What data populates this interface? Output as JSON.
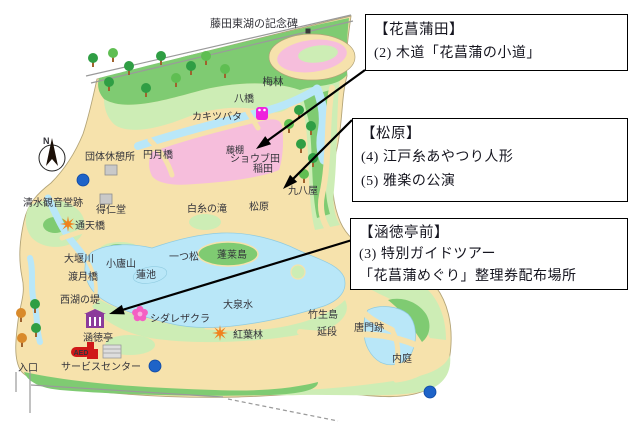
{
  "annotations": {
    "boxes": [
      {
        "id": "hanashobuda",
        "title": "【花菖蒲田】",
        "lines": [
          "(2) 木道「花菖蒲の小道」"
        ]
      },
      {
        "id": "matsubara",
        "title": "【松原】",
        "lines": [
          "(4) 江戸糸あやつり人形",
          "(5) 雅楽の公演"
        ]
      },
      {
        "id": "kantokutei-mae",
        "title": "【涵徳亭前】",
        "lines": [
          "(3) 特別ガイドツアー",
          "「花菖蒲めぐり」整理券配布場所"
        ]
      }
    ]
  },
  "map": {
    "colors": {
      "land": "#F6E2AC",
      "green": "#7FCB72",
      "green_light": "#CDEDB5",
      "green_dark": "#2F9E44",
      "water": "#B9E7F8",
      "pink_field": "#F6BEDC",
      "magenta": "#EE22DD",
      "orange": "#F0821E",
      "blue_marker": "#1E63C8",
      "purple": "#8B3A9B",
      "red": "#D01818",
      "gray": "#C9C9C9",
      "arrow": "#000000"
    },
    "labels": [
      {
        "id": "fujita-toko-monument",
        "text": "藤田東湖の記念碑",
        "x": 254,
        "y": 27,
        "size": 11
      },
      {
        "id": "bairin",
        "text": "梅林",
        "x": 273,
        "y": 85,
        "size": 10.5
      },
      {
        "id": "yatsuhashi",
        "text": "八橋",
        "x": 244,
        "y": 102,
        "size": 10
      },
      {
        "id": "kakitsubata",
        "text": "カキツバタ",
        "x": 217,
        "y": 120,
        "size": 10
      },
      {
        "id": "fujidana",
        "text": "藤棚",
        "x": 235,
        "y": 153,
        "size": 9
      },
      {
        "id": "shobuda",
        "text": "ショウブ田",
        "x": 255,
        "y": 162,
        "size": 10
      },
      {
        "id": "inada",
        "text": "稲田",
        "x": 263,
        "y": 172,
        "size": 10
      },
      {
        "id": "kuhachiya",
        "text": "九八屋",
        "x": 303,
        "y": 194,
        "size": 10
      },
      {
        "id": "group-rest-area",
        "text": "団体休憩所",
        "x": 110,
        "y": 160,
        "size": 10
      },
      {
        "id": "engetsukyo",
        "text": "円月橋",
        "x": 158,
        "y": 158,
        "size": 10
      },
      {
        "id": "kiyomizu-kannondo-ato",
        "text": "清水観音堂跡",
        "x": 53,
        "y": 206,
        "size": 10
      },
      {
        "id": "tokujindo",
        "text": "得仁堂",
        "x": 111,
        "y": 213,
        "size": 10
      },
      {
        "id": "tsutenkyo",
        "text": "通天橋",
        "x": 90,
        "y": 229,
        "size": 10
      },
      {
        "id": "shiraito-falls",
        "text": "白糸の滝",
        "x": 207,
        "y": 212,
        "size": 10
      },
      {
        "id": "matsubara",
        "text": "松原",
        "x": 259,
        "y": 210,
        "size": 10
      },
      {
        "id": "hitotsumatsu",
        "text": "一つ松",
        "x": 184,
        "y": 260,
        "size": 10
      },
      {
        "id": "oigawa",
        "text": "大堰川",
        "x": 79,
        "y": 262,
        "size": 10
      },
      {
        "id": "shorozan",
        "text": "小廬山",
        "x": 121,
        "y": 267,
        "size": 10
      },
      {
        "id": "hasuike",
        "text": "蓮池",
        "x": 146,
        "y": 278,
        "size": 10
      },
      {
        "id": "togetsukyo",
        "text": "渡月橋",
        "x": 83,
        "y": 280,
        "size": 10
      },
      {
        "id": "seiko-no-tsutsumi",
        "text": "西湖の堤",
        "x": 80,
        "y": 303,
        "size": 10
      },
      {
        "id": "horaijima",
        "text": "蓬莱島",
        "x": 232,
        "y": 258,
        "size": 10
      },
      {
        "id": "daisensui",
        "text": "大泉水",
        "x": 238,
        "y": 308,
        "size": 10
      },
      {
        "id": "shidarezakura",
        "text": "シダレザクラ",
        "x": 180,
        "y": 322,
        "size": 10
      },
      {
        "id": "kantokutei",
        "text": "涵徳亭",
        "x": 98,
        "y": 341,
        "size": 10
      },
      {
        "id": "momijibayashi",
        "text": "紅葉林",
        "x": 248,
        "y": 338,
        "size": 10
      },
      {
        "id": "chikubushima",
        "text": "竹生島",
        "x": 323,
        "y": 318,
        "size": 10
      },
      {
        "id": "nobedan",
        "text": "延段",
        "x": 327,
        "y": 335,
        "size": 10
      },
      {
        "id": "karamon-ato",
        "text": "唐門跡",
        "x": 369,
        "y": 331,
        "size": 10
      },
      {
        "id": "naitei",
        "text": "内庭",
        "x": 402,
        "y": 362,
        "size": 10
      },
      {
        "id": "service-center",
        "text": "サービスセンター",
        "x": 101,
        "y": 370,
        "size": 10
      },
      {
        "id": "entrance",
        "text": "入口",
        "x": 28,
        "y": 371,
        "size": 10
      }
    ],
    "icons": [
      {
        "type": "compass",
        "id": "compass",
        "x": 52,
        "y": 152,
        "label": "N"
      },
      {
        "type": "black-dot",
        "id": "monument-marker",
        "x": 308,
        "y": 31
      },
      {
        "type": "blue-dot",
        "id": "toilet-1",
        "x": 83,
        "y": 180
      },
      {
        "type": "blue-dot",
        "id": "toilet-2",
        "x": 155,
        "y": 366
      },
      {
        "type": "blue-dot",
        "id": "toilet-3",
        "x": 430,
        "y": 392
      },
      {
        "type": "gray-square",
        "id": "rest-house",
        "x": 111,
        "y": 170
      },
      {
        "type": "gray-square",
        "id": "tokujindo-hall",
        "x": 106,
        "y": 199
      },
      {
        "type": "orange-star",
        "id": "maple-tsutenkyo",
        "x": 68,
        "y": 224
      },
      {
        "type": "orange-star",
        "id": "maple-momijibayashi",
        "x": 220,
        "y": 333
      },
      {
        "type": "magenta-flower",
        "id": "kakitsubata-flower",
        "x": 262,
        "y": 114
      },
      {
        "type": "pink-flower",
        "id": "shidarezakura-blossom",
        "x": 140,
        "y": 314
      },
      {
        "type": "purple-building",
        "id": "kantokutei-house",
        "x": 95,
        "y": 321
      },
      {
        "type": "red-building",
        "id": "service-office",
        "x": 91,
        "y": 352
      },
      {
        "type": "aed-badge",
        "id": "aed",
        "x": 81,
        "y": 352,
        "label": "AED"
      },
      {
        "type": "gray-building",
        "id": "service-center-building",
        "x": 112,
        "y": 352
      },
      {
        "type": "tree",
        "v": "dark",
        "x": 93,
        "y": 61
      },
      {
        "type": "tree",
        "v": "mid",
        "x": 113,
        "y": 56
      },
      {
        "type": "tree",
        "v": "dark",
        "x": 129,
        "y": 69
      },
      {
        "type": "tree",
        "v": "dark",
        "x": 161,
        "y": 59
      },
      {
        "type": "tree",
        "v": "mid",
        "x": 176,
        "y": 81
      },
      {
        "type": "tree",
        "v": "dark",
        "x": 191,
        "y": 69
      },
      {
        "type": "tree",
        "v": "mid",
        "x": 206,
        "y": 59
      },
      {
        "type": "tree",
        "v": "mid",
        "x": 225,
        "y": 72
      },
      {
        "type": "tree",
        "v": "dark",
        "x": 109,
        "y": 85
      },
      {
        "type": "tree",
        "v": "dark",
        "x": 146,
        "y": 91
      },
      {
        "type": "tree",
        "v": "mid",
        "x": 289,
        "y": 127
      },
      {
        "type": "tree",
        "v": "dark",
        "x": 299,
        "y": 113
      },
      {
        "type": "tree",
        "v": "dark",
        "x": 311,
        "y": 129
      },
      {
        "type": "tree",
        "v": "dark",
        "x": 301,
        "y": 147
      },
      {
        "type": "tree",
        "v": "dark",
        "x": 313,
        "y": 161
      },
      {
        "type": "tree",
        "v": "mid",
        "x": 304,
        "y": 177
      },
      {
        "type": "tree",
        "v": "dark",
        "x": 35,
        "y": 307
      },
      {
        "type": "tree",
        "v": "orange",
        "x": 21,
        "y": 316
      },
      {
        "type": "tree",
        "v": "dark",
        "x": 36,
        "y": 331
      },
      {
        "type": "tree",
        "v": "orange",
        "x": 22,
        "y": 341
      }
    ],
    "arrows": [
      {
        "id": "arrow-to-shobuda",
        "x1": 365,
        "y1": 70,
        "x2": 256,
        "y2": 149
      },
      {
        "id": "arrow-to-matsubara",
        "x1": 352,
        "y1": 120,
        "x2": 283,
        "y2": 189
      },
      {
        "id": "arrow-to-kantokutei",
        "x1": 362,
        "y1": 237,
        "x2": 109,
        "y2": 314
      }
    ]
  }
}
